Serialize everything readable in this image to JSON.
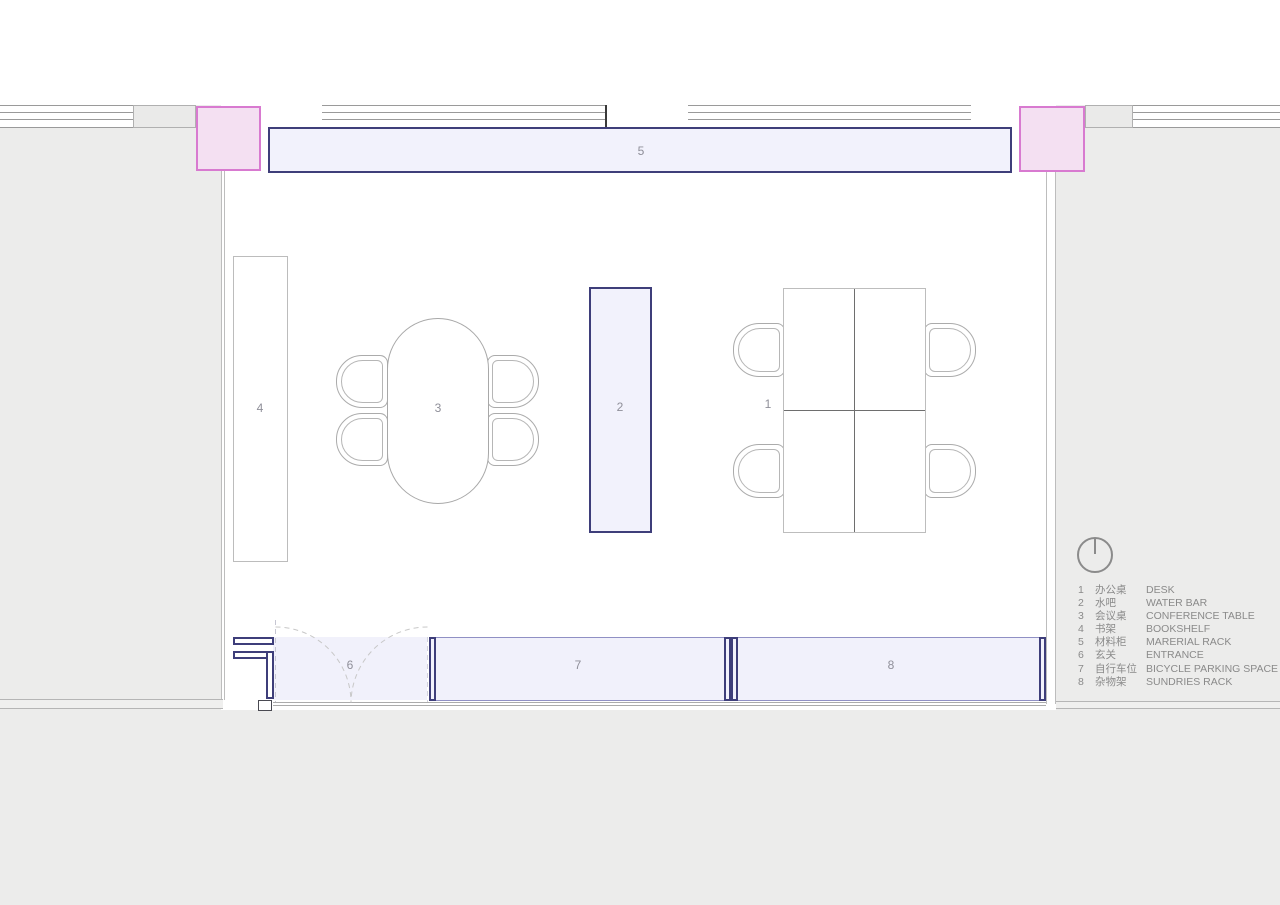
{
  "plan_labels": {
    "desk": "1",
    "water_bar": "2",
    "conference_table": "3",
    "bookshelf": "4",
    "material_rack": "5",
    "entrance": "6",
    "bicycle_parking": "7",
    "sundries_rack": "8"
  },
  "legend": {
    "rows": [
      {
        "num": "1",
        "cn": "办公桌",
        "en": "DESK"
      },
      {
        "num": "2",
        "cn": "水吧",
        "en": "WATER BAR"
      },
      {
        "num": "3",
        "cn": "会议桌",
        "en": "CONFERENCE TABLE"
      },
      {
        "num": "4",
        "cn": "书架",
        "en": "BOOKSHELF"
      },
      {
        "num": "5",
        "cn": "材料柜",
        "en": "MARERIAL RACK"
      },
      {
        "num": "6",
        "cn": "玄关",
        "en": "ENTRANCE"
      },
      {
        "num": "7",
        "cn": "自行车位",
        "en": "BICYCLE PARKING SPACE"
      },
      {
        "num": "8",
        "cn": "杂物架",
        "en": "SUNDRIES RACK"
      }
    ]
  },
  "icons": {
    "north_indicator": "north-indicator-icon",
    "door_swing": "door-swing-arcs"
  },
  "colors": {
    "background_gray": "#ececeb",
    "room_white": "#ffffff",
    "furniture_fill_lavender": "#f2f2fc",
    "furniture_border_navy": "#3e3e7a",
    "zone_border_purple": "#9090c4",
    "column_fill_pink": "#f4e0f2",
    "column_border_magenta": "#d87ad0",
    "wall_line_gray": "#b0b0b0",
    "label_text_gray": "#8f8f99",
    "legend_text_gray": "#8a8a8a"
  }
}
